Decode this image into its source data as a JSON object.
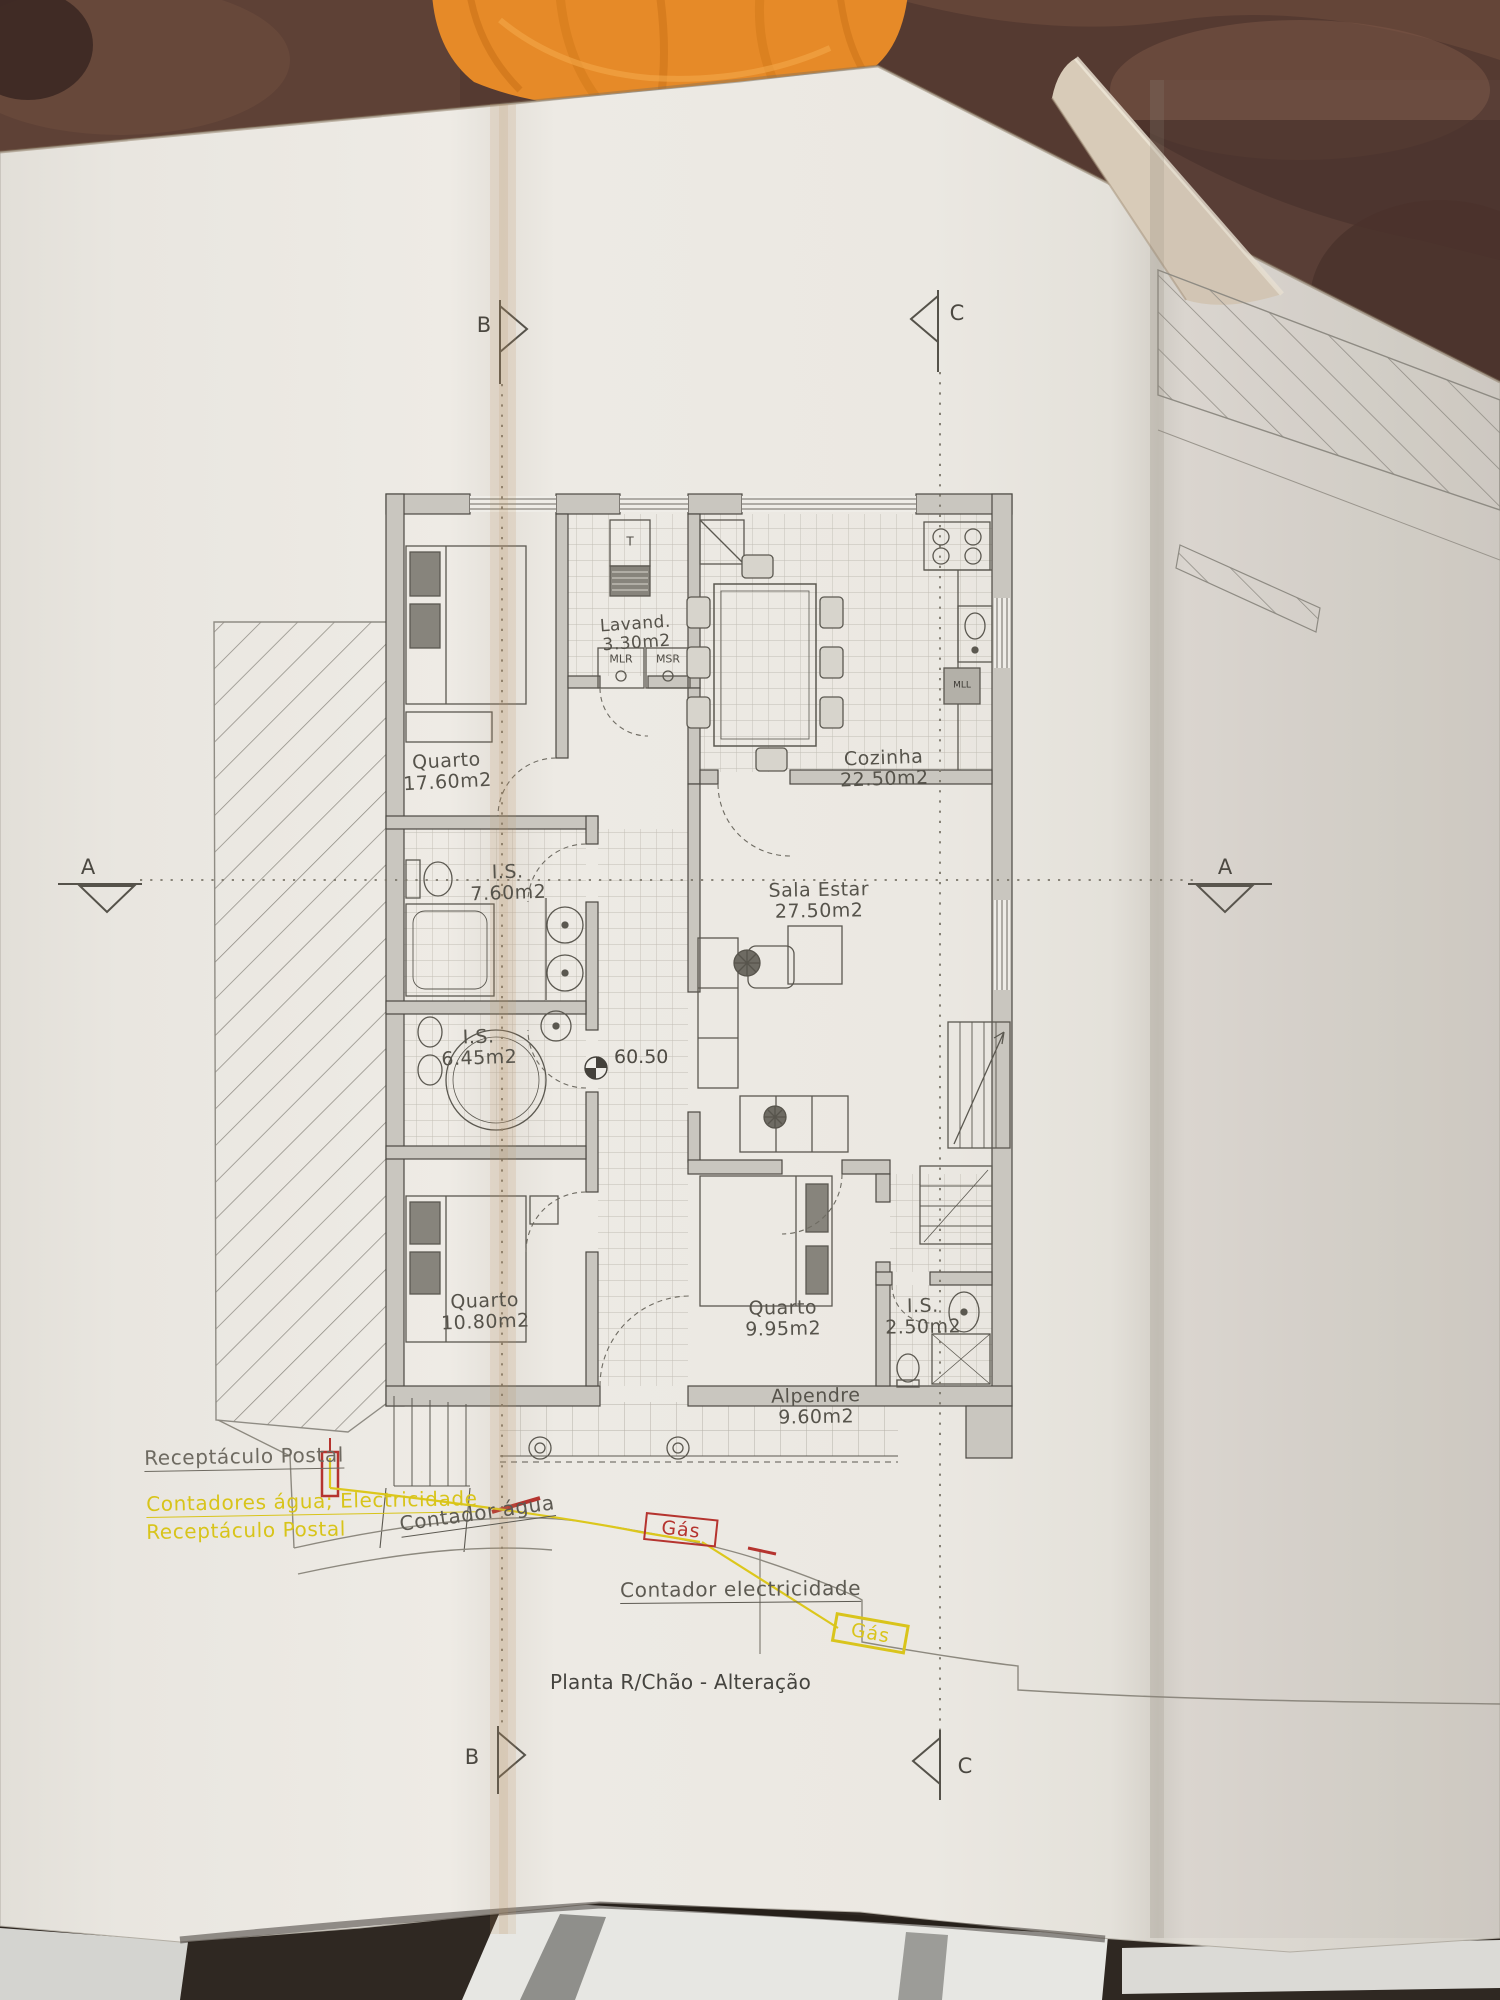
{
  "plan": {
    "title": "Planta R/Chão - Alteração",
    "level_marker": "60.50",
    "rooms": [
      {
        "name": "Quarto",
        "area": "17.60m2"
      },
      {
        "name": "Lavand.",
        "area": "3.30m2"
      },
      {
        "name": "Cozinha",
        "area": "22.50m2"
      },
      {
        "name": "I.S.",
        "area": "7.60m2"
      },
      {
        "name": "Sala Estar",
        "area": "27.50m2"
      },
      {
        "name": "I.S.",
        "area": "6.45m2"
      },
      {
        "name": "Quarto",
        "area": "10.80m2"
      },
      {
        "name": "Quarto",
        "area": "9.95m2"
      },
      {
        "name": "I.S.",
        "area": "2.50m2"
      },
      {
        "name": "Alpendre",
        "area": "9.60m2"
      }
    ],
    "appliances": {
      "water_heater": "T",
      "washer": "MLR",
      "dryer": "MSR",
      "dishwasher": "MLL"
    },
    "section_markers": {
      "a_left": "A",
      "a_right": "A",
      "b_top": "B",
      "b_bottom": "B",
      "c_top": "C",
      "c_bottom": "C"
    },
    "annotations": {
      "postal_black": "Receptáculo Postal",
      "meters_yellow": "Contadores água; Electricidade",
      "postal_yellow": "Receptáculo Postal",
      "water_meter": "Contador água",
      "gas_upper": "Gás",
      "electric_meter": "Contador electricidade",
      "gas_lower": "Gás"
    },
    "colors": {
      "ink": "#56534b",
      "yellow": "#d8c41a",
      "red": "#b5342f",
      "paper": "#e9e6e0",
      "cloth": "#e68a28",
      "table": "#553a31"
    }
  }
}
